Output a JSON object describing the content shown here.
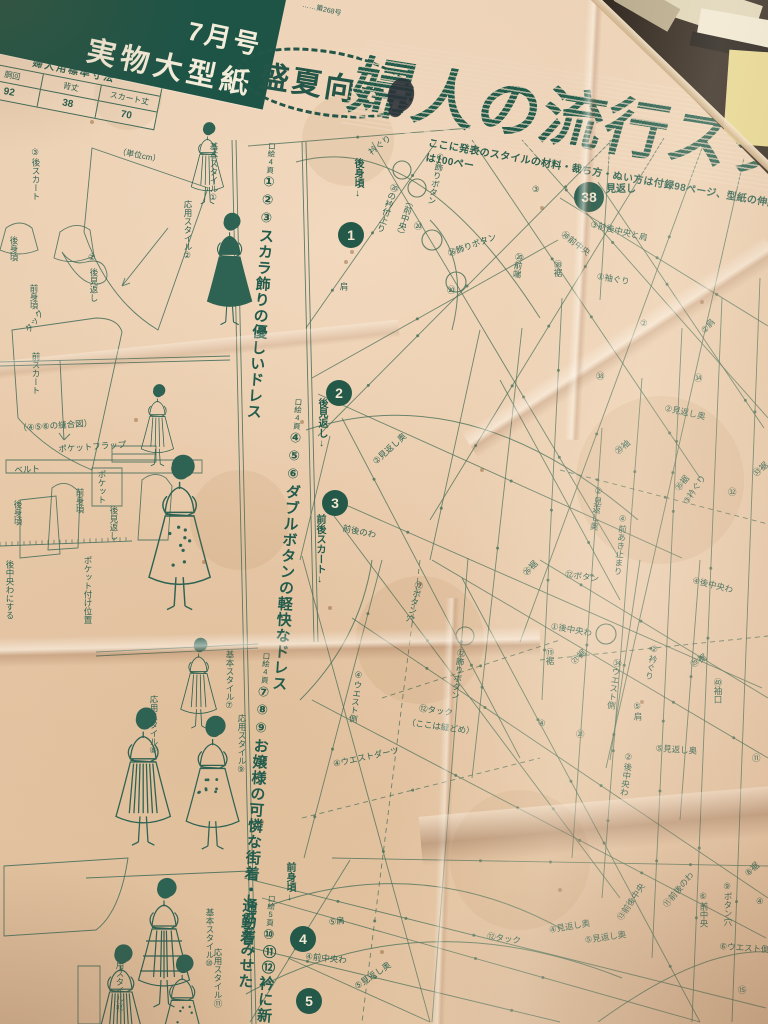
{
  "masthead": {
    "issue_banner": {
      "line1": "7月号",
      "line2": "実物大型紙"
    },
    "small_print": "……第268号",
    "badge": "盛夏向き",
    "main_title": "婦人の流行スタイル",
    "subtitle": "ここに発表のスタイルの材料・裁ち方・ぬい方は付録98ページ、型紙の伸縮法は100ペー"
  },
  "measurement_table": {
    "title": "婦人用標準寸法",
    "unit": "（単位cm）",
    "columns": [
      "胴回",
      "背丈",
      "スカート丈"
    ],
    "values": [
      "92",
      "38",
      "70"
    ]
  },
  "style_sections": [
    {
      "page_ref": "口絵4頁",
      "numbers": "①②③",
      "title": "スカラ飾りの優しいドレス"
    },
    {
      "page_ref": "口絵4頁",
      "numbers": "④⑤⑥",
      "title": "ダブルボタンの軽快なドレス"
    },
    {
      "page_ref": "口絵4頁",
      "numbers": "⑦⑧⑨",
      "title": "お嬢様の可憐な街着・通勤着"
    },
    {
      "page_ref": "口絵5頁",
      "numbers": "⑩⑪⑫",
      "title": "衿に新しさをみせた"
    }
  ],
  "piece_markers": [
    {
      "num": "1",
      "label": "後身頃",
      "x": 338,
      "y": 222,
      "lx": 350,
      "ly": 158,
      "lv": 1
    },
    {
      "num": "2",
      "label": "後見返し",
      "x": 326,
      "y": 380,
      "lx": 314,
      "ly": 398,
      "lv": 1
    },
    {
      "num": "3",
      "label": "前後スカート",
      "x": 322,
      "y": 490,
      "lx": 312,
      "ly": 514,
      "lv": 1
    },
    {
      "num": "4",
      "label": "前身頃",
      "x": 290,
      "y": 926,
      "lx": 282,
      "ly": 862,
      "lv": 1
    },
    {
      "num": "5",
      "label": "",
      "x": 296,
      "y": 988,
      "lx": 0,
      "ly": 0,
      "lv": 1
    },
    {
      "num": "38",
      "label": "見返し",
      "x": 574,
      "y": 182,
      "lx": 606,
      "ly": 180,
      "lv": 0
    }
  ],
  "pattern_labels": [
    {
      "t": "衿ぐり",
      "x": 366,
      "y": 148,
      "r": -38
    },
    {
      "t": "⑳の衿付上り",
      "x": 390,
      "y": 182,
      "v": 1,
      "r": 18
    },
    {
      "t": "（前中央）",
      "x": 406,
      "y": 196,
      "v": 1,
      "r": 18
    },
    {
      "t": "①飾りボタン",
      "x": 436,
      "y": 152,
      "v": 1,
      "r": 12
    },
    {
      "t": "⑳",
      "x": 414,
      "y": 220
    },
    {
      "t": "㉖飾りボタン",
      "x": 446,
      "y": 248,
      "r": -20
    },
    {
      "t": "⑳",
      "x": 447,
      "y": 284
    },
    {
      "t": "⑳前端",
      "x": 514,
      "y": 252,
      "v": 1,
      "r": 8
    },
    {
      "t": "③",
      "x": 532,
      "y": 184
    },
    {
      "t": "③前後中央と肩",
      "x": 592,
      "y": 218,
      "r": 14
    },
    {
      "t": "㊳前中央",
      "x": 566,
      "y": 228,
      "r": 38
    },
    {
      "t": "㊳裾",
      "x": 552,
      "y": 260,
      "v": 1
    },
    {
      "t": "①袖ぐり",
      "x": 598,
      "y": 270,
      "r": 10
    },
    {
      "t": "②",
      "x": 640,
      "y": 318
    },
    {
      "t": "②肩",
      "x": 698,
      "y": 328,
      "r": -48
    },
    {
      "t": "㊳",
      "x": 596,
      "y": 370
    },
    {
      "t": "㉞",
      "x": 694,
      "y": 372
    },
    {
      "t": "②見返し奥",
      "x": 666,
      "y": 402,
      "r": 12
    },
    {
      "t": "⑳袖",
      "x": 612,
      "y": 448,
      "r": -40
    },
    {
      "t": "㉟裾",
      "x": 672,
      "y": 486,
      "r": -52
    },
    {
      "t": "③衿ぐり",
      "x": 680,
      "y": 500,
      "r": -56
    },
    {
      "t": "㉝裾",
      "x": 750,
      "y": 470,
      "r": -40
    },
    {
      "t": "②見返し奥",
      "x": 594,
      "y": 486,
      "v": 1,
      "r": 8
    },
    {
      "t": "④前あき止まり",
      "x": 618,
      "y": 514,
      "v": 1,
      "r": 6
    },
    {
      "t": "④後中央わ",
      "x": 694,
      "y": 574,
      "r": 14
    },
    {
      "t": "㉜",
      "x": 728,
      "y": 486
    },
    {
      "t": "肩",
      "x": 338,
      "y": 282,
      "v": 1
    },
    {
      "t": "前後のわ",
      "x": 344,
      "y": 522,
      "r": 12
    },
    {
      "t": "②見返し奥",
      "x": 370,
      "y": 458,
      "r": -42
    },
    {
      "t": "⑫ボタン穴",
      "x": 414,
      "y": 580,
      "v": 1,
      "r": 14
    },
    {
      "t": "㉖裾",
      "x": 520,
      "y": 570,
      "r": -46
    },
    {
      "t": "⑫ボタン",
      "x": 566,
      "y": 568,
      "r": 8
    },
    {
      "t": "①後中央わ",
      "x": 552,
      "y": 620,
      "r": 10
    },
    {
      "t": "⑲裾",
      "x": 544,
      "y": 648,
      "v": 1
    },
    {
      "t": "㉑裾",
      "x": 568,
      "y": 658,
      "r": -42
    },
    {
      "t": "㉞ウエスト側",
      "x": 612,
      "y": 658,
      "v": 1,
      "r": 8
    },
    {
      "t": "②衿ぐり",
      "x": 650,
      "y": 644,
      "v": 1,
      "r": 12
    },
    {
      "t": "㉙裾",
      "x": 688,
      "y": 660,
      "r": -32
    },
    {
      "t": "㊵袖口",
      "x": 712,
      "y": 678,
      "v": 1
    },
    {
      "t": "⑤肩",
      "x": 632,
      "y": 702,
      "v": 1
    },
    {
      "t": "⑤見返し奥",
      "x": 656,
      "y": 742,
      "r": 4
    },
    {
      "t": "②後中央わ",
      "x": 624,
      "y": 752,
      "v": 1,
      "r": 8
    },
    {
      "t": "㉑",
      "x": 576,
      "y": 728
    },
    {
      "t": "⑪",
      "x": 752,
      "y": 752
    },
    {
      "t": "⑫飾りボタン",
      "x": 456,
      "y": 648,
      "v": 1,
      "r": 8
    },
    {
      "t": "⑫タック",
      "x": 420,
      "y": 702,
      "r": 8
    },
    {
      "t": "（ここは縫どめ）",
      "x": 408,
      "y": 716,
      "r": 8
    },
    {
      "t": "④ウエスト側",
      "x": 354,
      "y": 670,
      "v": 1,
      "r": 8
    },
    {
      "t": "④ウエストダーツ",
      "x": 332,
      "y": 758,
      "r": -12
    },
    {
      "t": "④",
      "x": 538,
      "y": 718
    },
    {
      "t": "⑤肩",
      "x": 328,
      "y": 916,
      "r": -6
    },
    {
      "t": "④前中央わ",
      "x": 306,
      "y": 950,
      "r": 6
    },
    {
      "t": "⑤見返し奥",
      "x": 352,
      "y": 982,
      "r": -34
    },
    {
      "t": "⑫タック",
      "x": 488,
      "y": 930,
      "r": 8
    },
    {
      "t": "④見返し奥",
      "x": 548,
      "y": 924,
      "r": -10
    },
    {
      "t": "⑤見返し奥",
      "x": 584,
      "y": 934,
      "r": -8
    },
    {
      "t": "⑬前後中央",
      "x": 614,
      "y": 916,
      "r": -56
    },
    {
      "t": "⑪前後のわ",
      "x": 660,
      "y": 902,
      "r": -50
    },
    {
      "t": "⑥前中央",
      "x": 698,
      "y": 892,
      "v": 1
    },
    {
      "t": "⑨ボタン穴",
      "x": 722,
      "y": 882,
      "v": 1
    },
    {
      "t": "⑥ウエスト側",
      "x": 720,
      "y": 940,
      "r": 4
    },
    {
      "t": "⑧裾",
      "x": 742,
      "y": 870,
      "r": -42
    },
    {
      "t": "④",
      "x": 756,
      "y": 896
    },
    {
      "t": "⑮",
      "x": 738,
      "y": 984
    }
  ],
  "left_labels": [
    {
      "t": "③後スカート",
      "x": 30,
      "y": 148,
      "v": 1
    },
    {
      "t": "後身頃",
      "x": 8,
      "y": 236,
      "v": 1
    },
    {
      "t": "前身頃",
      "x": 28,
      "y": 284,
      "v": 1
    },
    {
      "t": "②",
      "x": 88,
      "y": 252
    },
    {
      "t": "後見返し",
      "x": 88,
      "y": 268,
      "v": 1
    },
    {
      "t": "タック",
      "x": 22,
      "y": 328,
      "r": -55
    },
    {
      "t": "前スカート",
      "x": 30,
      "y": 352,
      "v": 1
    },
    {
      "t": "（④⑤⑥の縫合図）",
      "x": 18,
      "y": 422,
      "r": -4
    },
    {
      "t": "ポケットフラップ",
      "x": 58,
      "y": 443,
      "r": -4
    },
    {
      "t": "ベルト",
      "x": 14,
      "y": 464,
      "r": -3
    },
    {
      "t": "ポケット",
      "x": 96,
      "y": 470,
      "v": 1
    },
    {
      "t": "前身頃",
      "x": 74,
      "y": 488,
      "v": 1
    },
    {
      "t": "後身頃",
      "x": 12,
      "y": 500,
      "v": 1
    },
    {
      "t": "後見返し",
      "x": 108,
      "y": 506,
      "v": 1
    },
    {
      "t": "ポケット付け位置",
      "x": 82,
      "y": 556,
      "v": 1
    },
    {
      "t": "後中央わにする",
      "x": 4,
      "y": 560,
      "v": 1
    },
    {
      "t": "基本スタイル①",
      "x": 208,
      "y": 142,
      "v": 1
    },
    {
      "t": "応用スタイル②",
      "x": 182,
      "y": 200,
      "v": 1
    },
    {
      "t": "基本スタイル⑦",
      "x": 224,
      "y": 650,
      "v": 1
    },
    {
      "t": "応用スタイル⑧",
      "x": 148,
      "y": 695,
      "v": 1
    },
    {
      "t": "応用スタイル⑨",
      "x": 236,
      "y": 714,
      "v": 1
    },
    {
      "t": "基本スタイル⑩",
      "x": 204,
      "y": 908,
      "v": 1
    },
    {
      "t": "応用スタイル⑪",
      "x": 212,
      "y": 948,
      "v": 1
    },
    {
      "t": "応用スタイル⑫",
      "x": 114,
      "y": 952,
      "v": 1
    }
  ],
  "colors": {
    "paper": "#e9cdb0",
    "ink": "#2d6253",
    "line": "#4a7059",
    "banner": "#1d5446"
  }
}
